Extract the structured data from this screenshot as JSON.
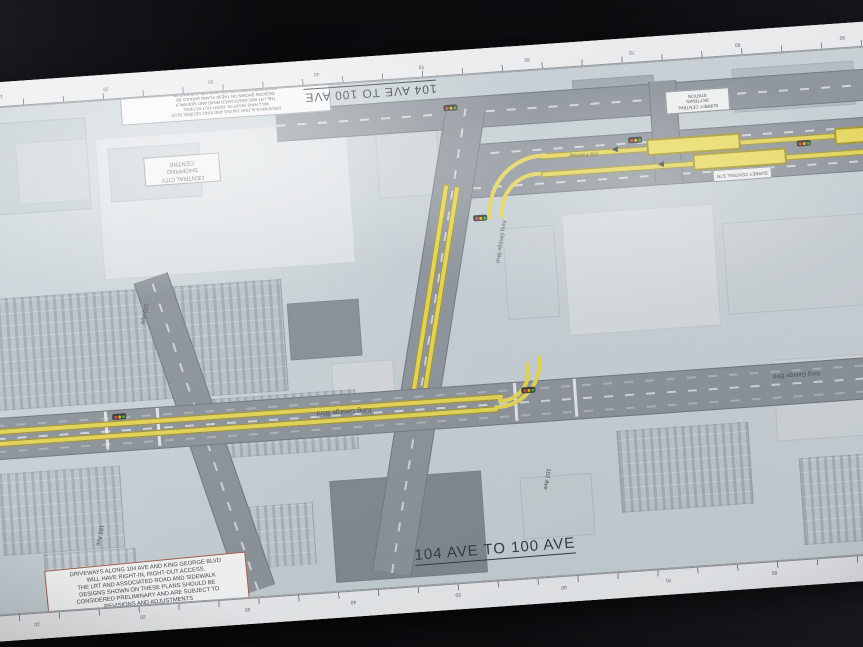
{
  "sheet": {
    "title_top": "104 AVE TO 100 AVE",
    "title_bottom": "104 AVE TO 100 AVE",
    "note_lines": [
      "DRIVEWAYS ALONG 104 AVE AND KING GEORGE BLVD",
      "WILL HAVE RIGHT-IN, RIGHT-OUT ACCESS.",
      "THE LRT AND ASSOCIATED ROAD AND SIDEWALK",
      "DESIGNS SHOWN ON THESE PLANS SHOULD BE",
      "CONSIDERED PRELIMINARY AND ARE SUBJECT TO",
      "REVISIONS AND ADJUSTMENTS"
    ],
    "labels": {
      "central_city_lines": [
        "CENTRAL CITY",
        "SHOPPING",
        "CENTRE"
      ],
      "station_area_lines": [
        "SURREY CENTRAL",
        "SKYTRAIN",
        "STATION"
      ],
      "station_platform": "SURREY CENTRAL STN",
      "road_main_1": "King George Blvd",
      "road_main_2": "King George Blvd",
      "road_c_upper": "King George Blvd",
      "road_c_lower": "102 Ave",
      "road_d_upper": "103 Ave",
      "road_d_lower": "101 Ave",
      "road_lrt": "City Parkway"
    },
    "ruler_labels": [
      "10",
      "20",
      "30",
      "40",
      "50",
      "60",
      "70",
      "80",
      "90"
    ],
    "colors": {
      "paper": "#edeff0",
      "map_base": "#c5cfd4",
      "road": "#8a9198",
      "lrt": "#e9d74f",
      "title_ink": "#2e3338",
      "signal_red": "#d84339",
      "signal_amber": "#e8b400",
      "signal_green": "#3fa23f"
    }
  }
}
